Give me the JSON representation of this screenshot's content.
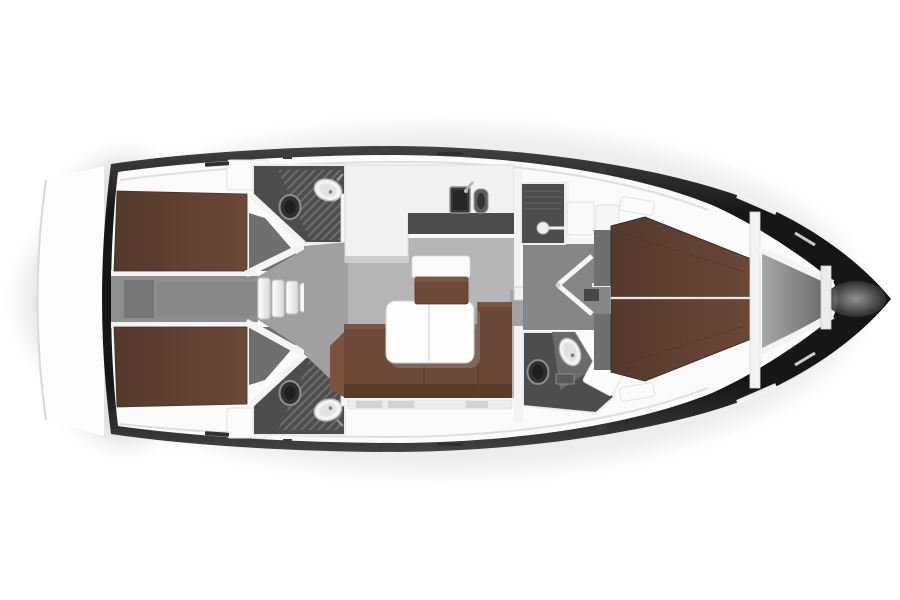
{
  "meta": {
    "title": "Sailing yacht interior layout plan",
    "view": "top-down floor plan, bow to the right, no text labels"
  },
  "palette": {
    "background": "#ffffff",
    "hullEdge": "#424242",
    "hullCore": "#161616",
    "deckWhite": "#fbfbfb",
    "wallWhite": "#f4f4f4",
    "floorGray": "#b5b5b5",
    "floorMid": "#a0a0a0",
    "floorDark": "#6f6f6f",
    "wetFloor": "#4d4d4d",
    "engineGray": "#8f8f8f",
    "mattressBrown": "#6b4838",
    "mattressDark": "#55392c",
    "sofaBrown": "#6f4a38",
    "sofaBackBrown": "#593b2c",
    "sofaHighlight": "#7d5642",
    "tableWhite": "#fdfdfd",
    "grateLine": "#6e6e6e",
    "shadowGray": "#e6e6e6"
  },
  "regions": {
    "hull": {
      "label": "Hull"
    },
    "swim_platform": {
      "label": "Stern swim platform outline"
    },
    "deck": {
      "label": "Side decks"
    },
    "aft_cabin_port": {
      "label": "Aft double cabin (port)"
    },
    "aft_cabin_starboard": {
      "label": "Aft double cabin (starboard)"
    },
    "engine_compartment": {
      "label": "Engine compartment"
    },
    "companionway_steps": {
      "label": "Companionway steps"
    },
    "aft_head_port": {
      "label": "Aft head with shower (port)"
    },
    "aft_head_starboard": {
      "label": "Aft head with shower (starboard)"
    },
    "galley": {
      "label": "L-shaped galley with twin sinks"
    },
    "saloon": {
      "label": "Saloon"
    },
    "saloon_table": {
      "label": "Saloon table"
    },
    "saloon_sofa": {
      "label": "L-shaped saloon sofa"
    },
    "chart_seat": {
      "label": "Navigation seat with table"
    },
    "passageway": {
      "label": "Forward passageway with cabin doors"
    },
    "forward_shower": {
      "label": "Forward shower compartment"
    },
    "forward_head": {
      "label": "Forward head"
    },
    "forward_cabin": {
      "label": "Forward cabin with island berth"
    },
    "anchor_locker": {
      "label": "Anchor locker"
    },
    "bow": {
      "label": "Bow"
    }
  }
}
